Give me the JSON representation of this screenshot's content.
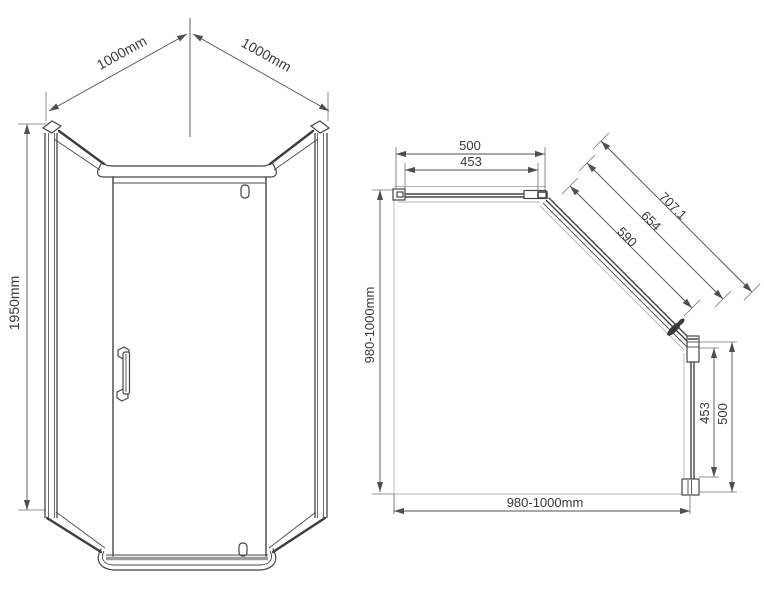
{
  "front_view": {
    "width_left_label": "1000mm",
    "width_right_label": "1000mm",
    "height_label": "1950mm"
  },
  "plan_view": {
    "top_overall_label": "500",
    "top_glass_label": "453",
    "diagonal_overall_label": "707.1",
    "diagonal_mid_label": "654",
    "diagonal_glass_label": "590",
    "left_depth_label": "980-1000mm",
    "bottom_width_label": "980-1000mm",
    "right_glass_label": "453",
    "right_overall_label": "500"
  },
  "colors": {
    "line": "#454545",
    "dimension": "#4f4f4f",
    "faint": "#b5b5b5",
    "text": "#3a3a3a",
    "threshold_gray": "#9c9c9c",
    "background": "#ffffff"
  }
}
